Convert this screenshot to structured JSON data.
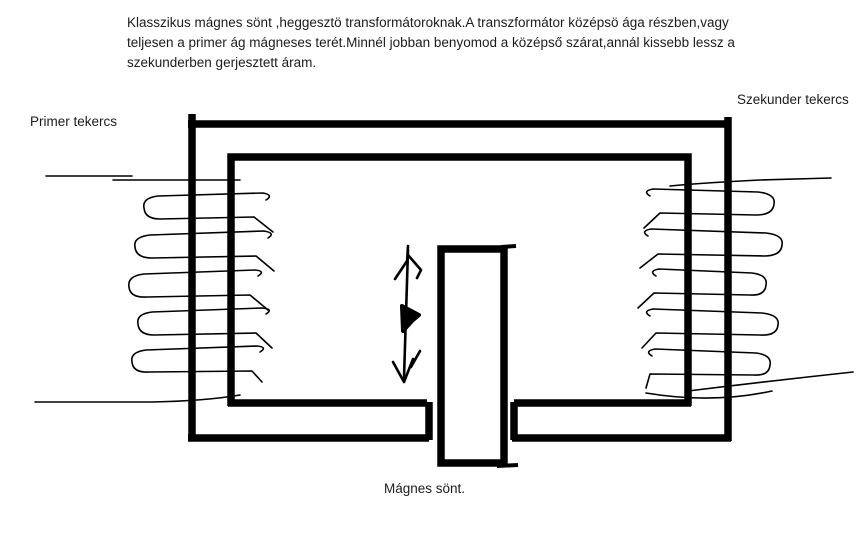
{
  "canvas": {
    "background": "#ffffff",
    "ink_color": "#000000",
    "text_color": "#1c1c1c"
  },
  "caption": {
    "lines": [
      "Klasszikus mágnes sönt ,heggesztö transformátoroknak.A transzformátor középsö ága részben,vagy",
      "teljesen a primer ág mágneses terét.Minnél jobban benyomod a középső szárat,annál kissebb lessz a",
      "szekunderben gerjesztett áram."
    ]
  },
  "labels": {
    "primary_coil": "Primer tekercs",
    "secondary_coil": "Szekunder tekercs",
    "magnetic_shunt": "Mágnes sönt."
  }
}
